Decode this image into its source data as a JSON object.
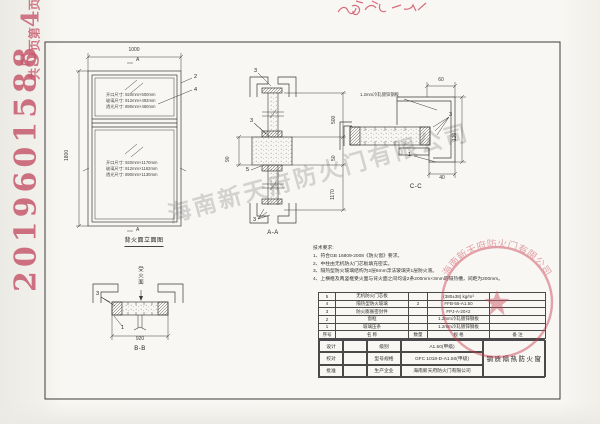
{
  "stamps": {
    "doc_number": "2019601588",
    "page_note_parts": [
      "共",
      "5",
      "页",
      "第",
      "4",
      "页"
    ],
    "seal_company": "海南新天府防火门有限公司"
  },
  "watermark_text": "海南新天府防火门有限公司",
  "elevation": {
    "title": "背火面立面图",
    "dim_width": "1000",
    "dim_height": "1800",
    "section_mark_top": "A",
    "section_mark_bottom": "A",
    "callout_frame": "2",
    "callout_glass": "4",
    "upper_pane": {
      "opening": "开口尺寸: 920mm×500mm",
      "glass": "玻璃尺寸: 912mm×492mm",
      "daylight": "透光尺寸: 890mm×460mm"
    },
    "lower_pane": {
      "opening": "开口尺寸: 920mm×1170mm",
      "glass": "玻璃尺寸: 912mm×1162mm",
      "daylight": "透光尺寸: 890mm×1130mm"
    }
  },
  "section_aa": {
    "label": "A-A",
    "dim_top": "500",
    "dim_mid": "50",
    "dim_bottom": "1170",
    "dim_mullion": "90",
    "callout_top": "3",
    "callout_mid": "3",
    "callout_core": "5",
    "callout_bottom": "3"
  },
  "section_cc": {
    "label": "C-C",
    "steel_note": "1.2mm冷轧镀锌钢板",
    "dim_top": "60",
    "dim_right": "120",
    "dim_bottom": "40",
    "callout_seal": "3",
    "callout_bead": "1"
  },
  "section_bb": {
    "label": "B-B",
    "fire_side": "受火面",
    "dim_width": "920",
    "callout_seal": "3",
    "callout_bead": "1"
  },
  "tech": {
    "title": "技术要求:",
    "items": [
      "1、符合GB 16809-2008《防火窗》要求。",
      "2、中柱由无机防火门芯板填充密实。",
      "3、隔热型防火玻璃结构为2层8mm浮法玻璃夹1层防火液。",
      "4、上横框及两竖框受火面与背火面之间均设2条200mm×3mm的隔热槽，间距为200mm。"
    ]
  },
  "parts_table": {
    "headers": {
      "no": "序号",
      "name": "名  称",
      "qty": "数量",
      "spec": "规  格",
      "note": "备  注"
    },
    "rows": [
      {
        "no": "5",
        "name": "无机防火门芯板",
        "qty": "",
        "spec": "(380±38) kg/m³",
        "note": ""
      },
      {
        "no": "4",
        "name": "隔热型防火玻璃",
        "qty": "2",
        "spec": "FFB-55-A1.50",
        "note": ""
      },
      {
        "no": "3",
        "name": "防火膨胀密封件",
        "qty": "",
        "spec": "FPJ-A-20×2",
        "note": ""
      },
      {
        "no": "2",
        "name": "窗框",
        "qty": "",
        "spec": "1.2mm冷轧镀锌钢板",
        "note": ""
      },
      {
        "no": "1",
        "name": "玻璃压条",
        "qty": "",
        "spec": "1.2mm冷轧镀锌钢板",
        "note": ""
      }
    ]
  },
  "title_block": {
    "design_label": "设计",
    "check_label": "校对",
    "approve_label": "批准",
    "grade_label": "级别",
    "grade_value": "A1.50(甲级)",
    "model_label": "型号规格",
    "model_value": "GFC 1018-D-A1.50(甲级)",
    "producer_label": "生产企业",
    "producer_value": "海南新天府防火门有限公司",
    "product_name": "钢质隔热防火窗"
  }
}
